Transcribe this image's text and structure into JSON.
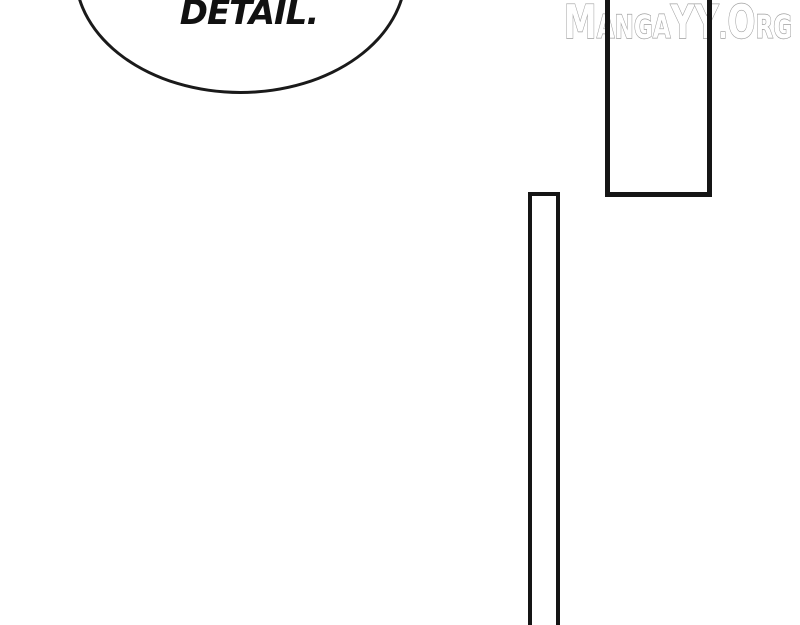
{
  "page": {
    "background_color": "#ffffff",
    "ink_color": "#1a1a1a"
  },
  "speech_bubble": {
    "text": "DETAIL."
  },
  "watermark": {
    "text": "MangaYY.Org",
    "fill_color": "#ffffff",
    "outline_color": "#9e9e9e"
  }
}
